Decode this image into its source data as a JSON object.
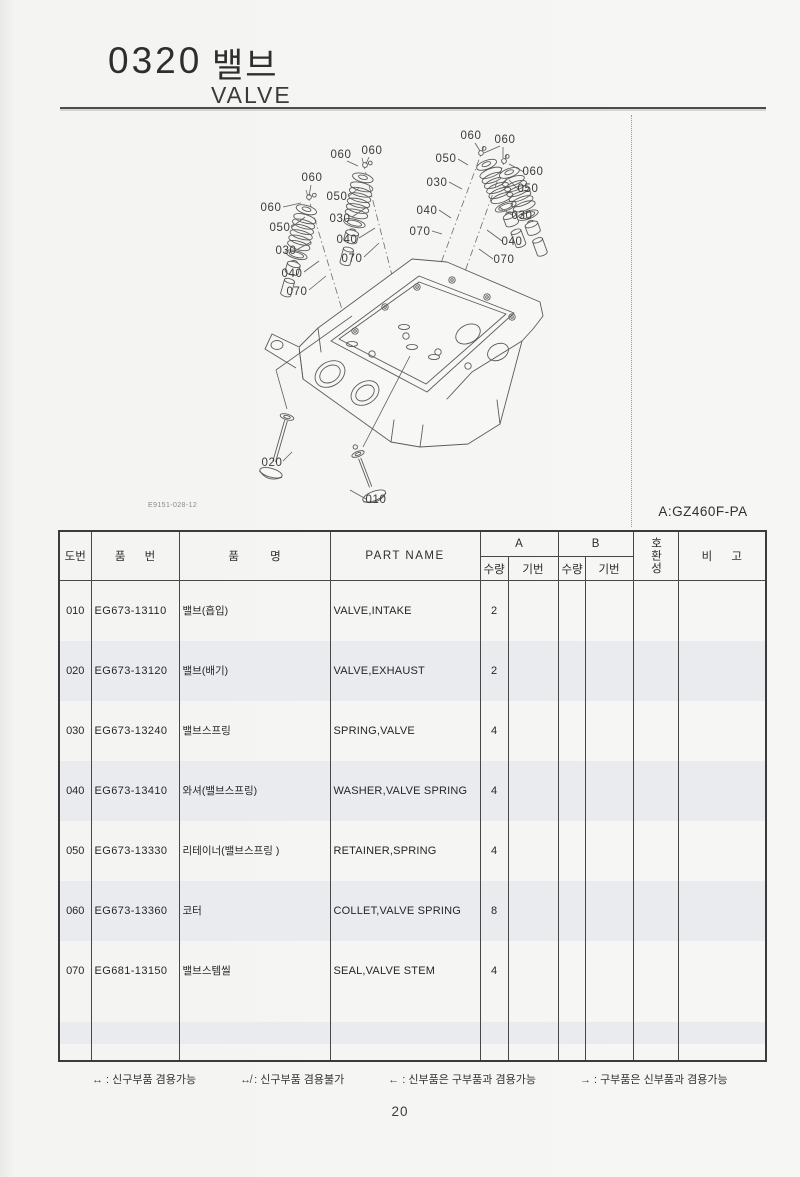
{
  "page": {
    "code": "0320",
    "title_ko": "밸브",
    "title_en": "VALVE",
    "drawing_no": "E9151-028-12",
    "model_key": "A:GZ460F-PA",
    "page_number": "20"
  },
  "diagram": {
    "description": "Exploded view of cylinder head valve components: four valve spring assemblies above the head, intake and exhaust valves below",
    "callouts": [
      {
        "label": "060",
        "tx": 312,
        "ty": 181,
        "x1": 311,
        "y1": 185,
        "x2": 309,
        "y2": 196
      },
      {
        "label": "060",
        "tx": 271,
        "ty": 211,
        "x1": 283,
        "y1": 207,
        "x2": 301,
        "y2": 203
      },
      {
        "label": "050",
        "tx": 280,
        "ty": 231,
        "x1": 292,
        "y1": 227,
        "x2": 305,
        "y2": 217
      },
      {
        "label": "030",
        "tx": 286,
        "ty": 254,
        "x1": 298,
        "y1": 249,
        "x2": 311,
        "y2": 242
      },
      {
        "label": "040",
        "tx": 292,
        "ty": 277,
        "x1": 304,
        "y1": 272,
        "x2": 319,
        "y2": 261
      },
      {
        "label": "070",
        "tx": 297,
        "ty": 295,
        "x1": 309,
        "y1": 290,
        "x2": 326,
        "y2": 276
      },
      {
        "label": "060",
        "tx": 341,
        "ty": 158,
        "x1": 347,
        "y1": 161,
        "x2": 358,
        "y2": 166
      },
      {
        "label": "060",
        "tx": 372,
        "ty": 154,
        "x1": 369,
        "y1": 157,
        "x2": 366,
        "y2": 164
      },
      {
        "label": "050",
        "tx": 337,
        "ty": 200,
        "x1": 349,
        "y1": 196,
        "x2": 359,
        "y2": 188
      },
      {
        "label": "030",
        "tx": 340,
        "ty": 222,
        "x1": 352,
        "y1": 217,
        "x2": 367,
        "y2": 207
      },
      {
        "label": "040",
        "tx": 347,
        "ty": 243,
        "x1": 359,
        "y1": 238,
        "x2": 375,
        "y2": 228
      },
      {
        "label": "070",
        "tx": 352,
        "ty": 262,
        "x1": 364,
        "y1": 257,
        "x2": 379,
        "y2": 243
      },
      {
        "label": "060",
        "tx": 471,
        "ty": 139,
        "x1": 475,
        "y1": 143,
        "x2": 480,
        "y2": 151
      },
      {
        "label": "050",
        "tx": 446,
        "ty": 162,
        "x1": 458,
        "y1": 159,
        "x2": 468,
        "y2": 165
      },
      {
        "label": "030",
        "tx": 437,
        "ty": 186,
        "x1": 449,
        "y1": 182,
        "x2": 462,
        "y2": 189
      },
      {
        "label": "040",
        "tx": 427,
        "ty": 214,
        "x1": 439,
        "y1": 210,
        "x2": 451,
        "y2": 218
      },
      {
        "label": "070",
        "tx": 420,
        "ty": 235,
        "x1": 432,
        "y1": 231,
        "x2": 442,
        "y2": 234
      },
      {
        "label": "060",
        "tx": 505,
        "ty": 143,
        "x1": 503,
        "y1": 147,
        "x2": 503,
        "y2": 158
      },
      {
        "label": "060",
        "tx": 533,
        "ty": 175,
        "x1": 524,
        "y1": 172,
        "x2": 509,
        "y2": 164
      },
      {
        "label": "050",
        "tx": 528,
        "ty": 192,
        "x1": 518,
        "y1": 189,
        "x2": 509,
        "y2": 180
      },
      {
        "label": "030",
        "tx": 522,
        "ty": 219,
        "x1": 512,
        "y1": 215,
        "x2": 499,
        "y2": 207
      },
      {
        "label": "040",
        "tx": 512,
        "ty": 245,
        "x1": 502,
        "y1": 241,
        "x2": 487,
        "y2": 230
      },
      {
        "label": "070",
        "tx": 504,
        "ty": 263,
        "x1": 493,
        "y1": 259,
        "x2": 479,
        "y2": 249
      },
      {
        "label": "020",
        "tx": 272,
        "ty": 466,
        "x1": 283,
        "y1": 461,
        "x2": 292,
        "y2": 452
      },
      {
        "label": "010",
        "tx": 376,
        "ty": 503,
        "x1": 366,
        "y1": 499,
        "x2": 350,
        "y2": 490
      }
    ]
  },
  "table": {
    "headers": {
      "no": "도번",
      "part_no": "품 번",
      "name_ko": "품 명",
      "part_name": "PART NAME",
      "col_a": "A",
      "col_b": "B",
      "qty": "수량",
      "serial": "기번",
      "compat": "호환성",
      "remarks": "비 고"
    },
    "rows": [
      {
        "no": "010",
        "part_no": "EG673-13110",
        "name_ko": "밸브(흡입)",
        "part_name": "VALVE,INTAKE",
        "qty_a": "2",
        "ser_a": "",
        "qty_b": "",
        "ser_b": "",
        "compat": "",
        "remarks": ""
      },
      {
        "no": "020",
        "part_no": "EG673-13120",
        "name_ko": "밸브(배기)",
        "part_name": "VALVE,EXHAUST",
        "qty_a": "2",
        "ser_a": "",
        "qty_b": "",
        "ser_b": "",
        "compat": "",
        "remarks": ""
      },
      {
        "no": "030",
        "part_no": "EG673-13240",
        "name_ko": "밸브스프링",
        "part_name": "SPRING,VALVE",
        "qty_a": "4",
        "ser_a": "",
        "qty_b": "",
        "ser_b": "",
        "compat": "",
        "remarks": ""
      },
      {
        "no": "040",
        "part_no": "EG673-13410",
        "name_ko": "와셔(밸브스프링)",
        "part_name": "WASHER,VALVE SPRING",
        "qty_a": "4",
        "ser_a": "",
        "qty_b": "",
        "ser_b": "",
        "compat": "",
        "remarks": ""
      },
      {
        "no": "050",
        "part_no": "EG673-13330",
        "name_ko": "리테이너(밸브스프링 )",
        "part_name": "RETAINER,SPRING",
        "qty_a": "4",
        "ser_a": "",
        "qty_b": "",
        "ser_b": "",
        "compat": "",
        "remarks": ""
      },
      {
        "no": "060",
        "part_no": "EG673-13360",
        "name_ko": "코터",
        "part_name": "COLLET,VALVE SPRING",
        "qty_a": "8",
        "ser_a": "",
        "qty_b": "",
        "ser_b": "",
        "compat": "",
        "remarks": ""
      },
      {
        "no": "070",
        "part_no": "EG681-13150",
        "name_ko": "밸브스템씰",
        "part_name": "SEAL,VALVE STEM",
        "qty_a": "4",
        "ser_a": "",
        "qty_b": "",
        "ser_b": "",
        "compat": "",
        "remarks": ""
      }
    ]
  },
  "legend": {
    "items": [
      {
        "symbol": "↔",
        "text": ": 신구부품 겸용가능"
      },
      {
        "symbol": "↮",
        "text": ": 신구부품 겸용불가"
      },
      {
        "symbol": "←",
        "text": ": 신부품은 구부품과 겸용가능"
      },
      {
        "symbol": "→",
        "text": ": 구부품은 신부품과 겸용가능"
      }
    ]
  },
  "colors": {
    "paper": "#f6f6f4",
    "table_line": "#474747",
    "stripe": "#e9ebee",
    "ink": "#2b2b2b"
  }
}
